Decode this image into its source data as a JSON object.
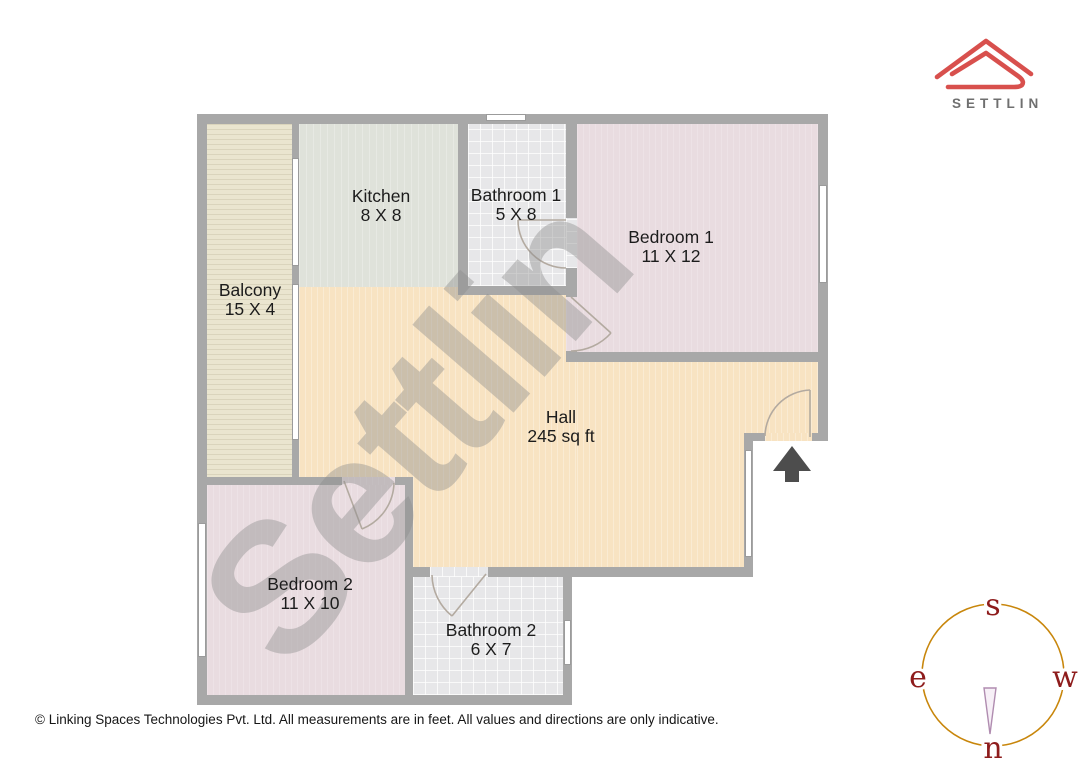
{
  "brand": {
    "logo_text": "SETTLIN",
    "logo_color": "#d8504d",
    "text_color": "#6f6f6f"
  },
  "watermark": {
    "text": "Settlin"
  },
  "floorplan": {
    "rooms": [
      {
        "id": "balcony",
        "name": "Balcony",
        "dims": "15 X 4"
      },
      {
        "id": "kitchen",
        "name": "Kitchen",
        "dims": "8 X 8"
      },
      {
        "id": "bathroom1",
        "name": "Bathroom 1",
        "dims": "5 X 8"
      },
      {
        "id": "bedroom1",
        "name": "Bedroom 1",
        "dims": "11 X 12"
      },
      {
        "id": "hall",
        "name": "Hall",
        "dims": "245 sq ft"
      },
      {
        "id": "bedroom2",
        "name": "Bedroom 2",
        "dims": "11 X 10"
      },
      {
        "id": "bathroom2",
        "name": "Bathroom 2",
        "dims": "6 X 7"
      }
    ],
    "entrance_arrow_color": "#4d4d4d"
  },
  "compass": {
    "top": "s",
    "left": "e",
    "right": "w",
    "bottom": "n",
    "circle_color": "#c8860b",
    "letter_color": "#8e1c1c"
  },
  "footer": {
    "copyright": "© Linking Spaces Technologies Pvt. Ltd. All measurements are in feet. All values and directions are only indicative."
  }
}
